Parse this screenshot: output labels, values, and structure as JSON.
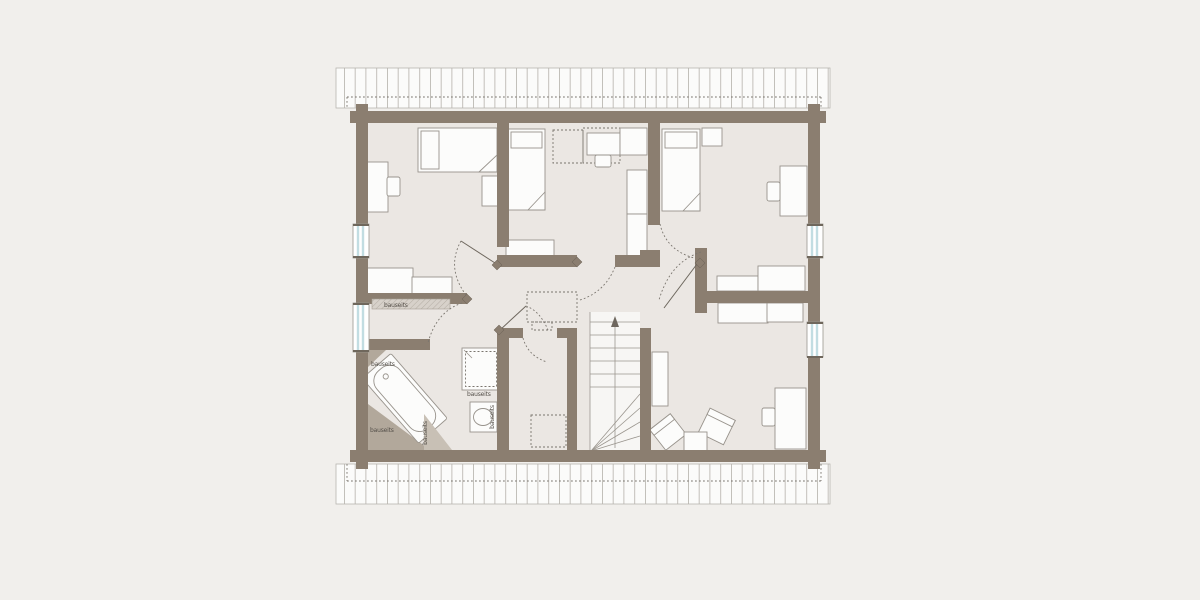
{
  "plan": {
    "type": "floor-plan",
    "labels": {
      "shelf_hall": "bauseits",
      "bath_top_left": "bauseits",
      "bath_bottom_left": "bauseits",
      "below_shower": "bauseits",
      "bath_knee_right_rotated": "bauseits",
      "bath_basin_wall_rotated": "bauseits"
    },
    "colors": {
      "background": "#f1efec",
      "floor": "#ebe7e3",
      "wall": "#8b7e70",
      "furniture": "#fcfcfb",
      "furniture_stroke": "#98938c",
      "window_glass": "#c2dde2",
      "hatch_band": "#d7d1ca",
      "knee_shading_dark": "#b2a89b",
      "knee_shading_light": "#c8c0b5",
      "roof_overhang": "#fbfbfa",
      "roof_batten_line": "#b5b1ab",
      "dashed_line": "#7a756e",
      "label_text": "#55504a"
    },
    "counts": {
      "windows": "4",
      "bauseits_labels": "6"
    }
  }
}
